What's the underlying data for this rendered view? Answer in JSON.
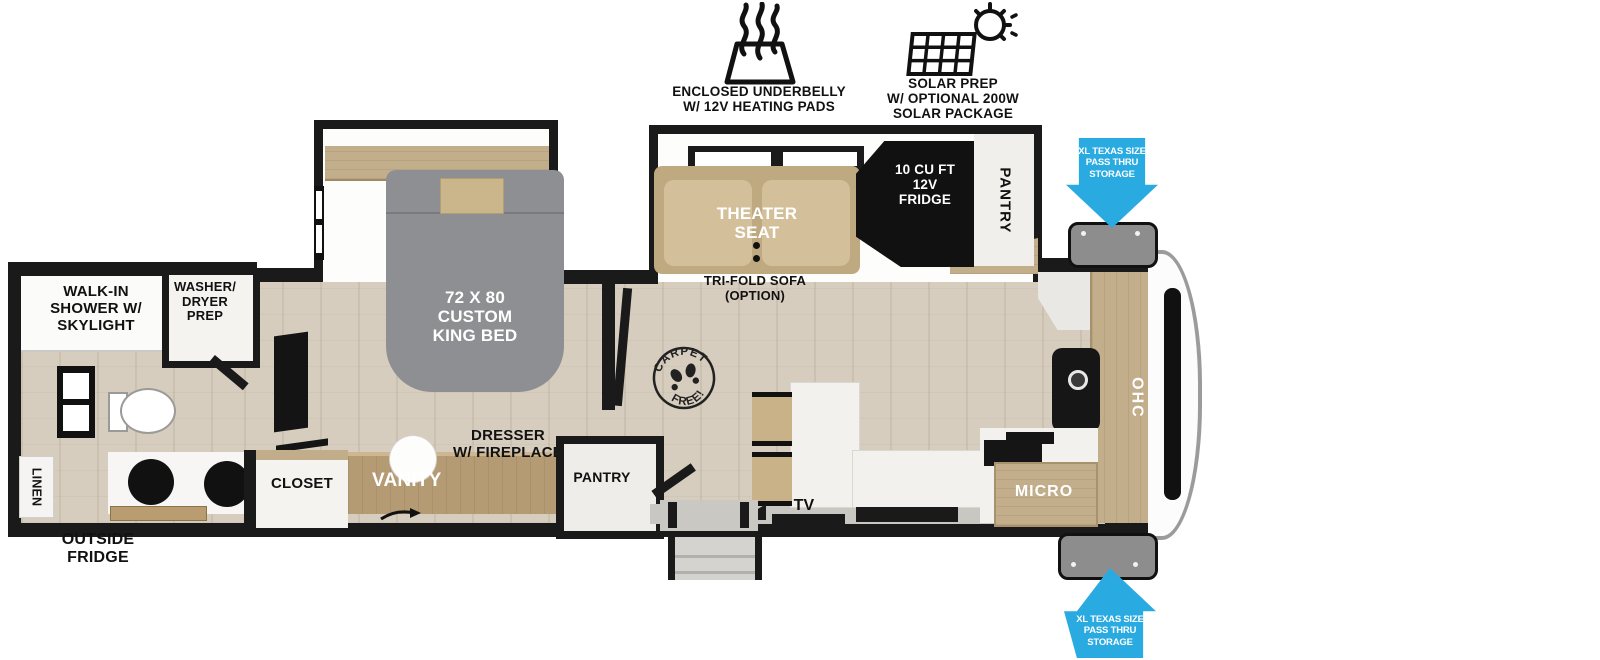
{
  "header": {
    "underbelly_label": "ENCLOSED UNDERBELLY\nW/ 12V HEATING PADS",
    "solar_label": "SOLAR PREP\nW/ OPTIONAL 200W\nSOLAR PACKAGE"
  },
  "rooms": {
    "shower": "WALK-IN\nSHOWER W/\nSKYLIGHT",
    "washer_dryer": "WASHER/\nDRYER\nPREP",
    "linen": "LINEN",
    "outside_fridge": "OUTSIDE\nFRIDGE",
    "king_bed": "72 X 80\nCUSTOM\nKING BED",
    "closet": "CLOSET",
    "vanity": "VANITY",
    "dresser_fireplace": "DRESSER\nW/ FIREPLACE",
    "pantry_bedroom": "PANTRY",
    "theater_seat": "THEATER\nSEAT",
    "trifold_sofa": "TRI-FOLD SOFA\n(OPTION)",
    "fridge": "10 CU FT\n12V\nFRIDGE",
    "pantry_kitchen": "PANTRY",
    "tv": "TV",
    "micro": "MICRO",
    "ohc": "OHC"
  },
  "stamp": {
    "top": "CARPET",
    "bottom": "FREE!"
  },
  "storage": {
    "pass_thru": "XL TEXAS SIZE\nPASS THRU\nSTORAGE"
  },
  "colors": {
    "accent_blue": "#29ABE2",
    "wall_black": "#1A1A1A",
    "floor_wood": "#D6CDBE",
    "cabinet_wood": "#C3AE8C",
    "bed_gray": "#8E8F92",
    "seat_tan": "#C9B58D",
    "storage_door_gray": "#8D8D8D"
  }
}
